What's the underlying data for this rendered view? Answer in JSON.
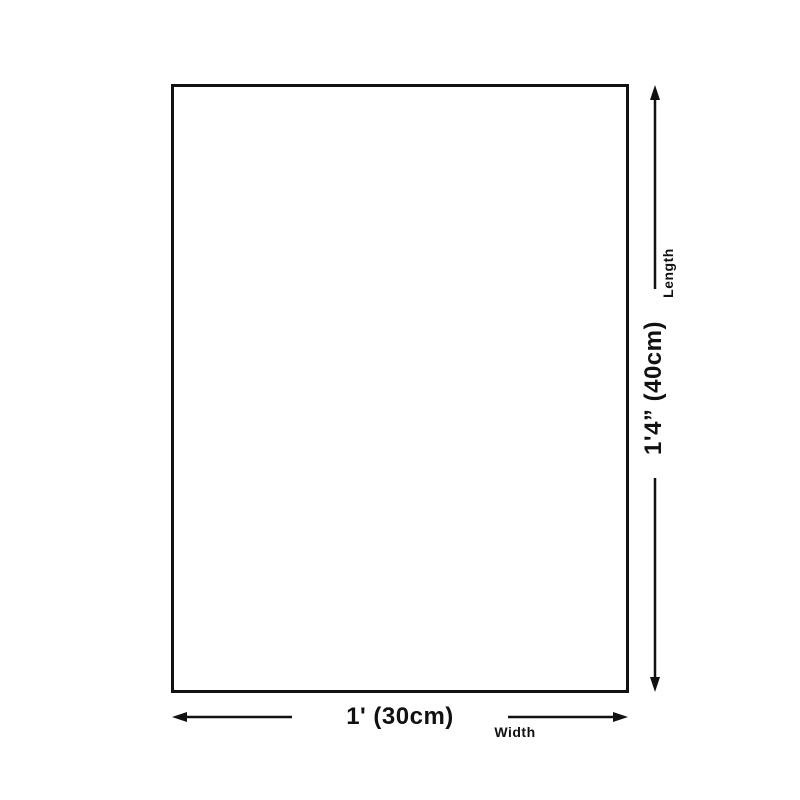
{
  "diagram": {
    "colors": {
      "line": "#111111",
      "background": "#ffffff"
    },
    "length_dimension": {
      "value": "1'4” (40cm)",
      "label": "Length"
    },
    "width_dimension": {
      "value": "1' (30cm)",
      "label": "Width"
    }
  }
}
